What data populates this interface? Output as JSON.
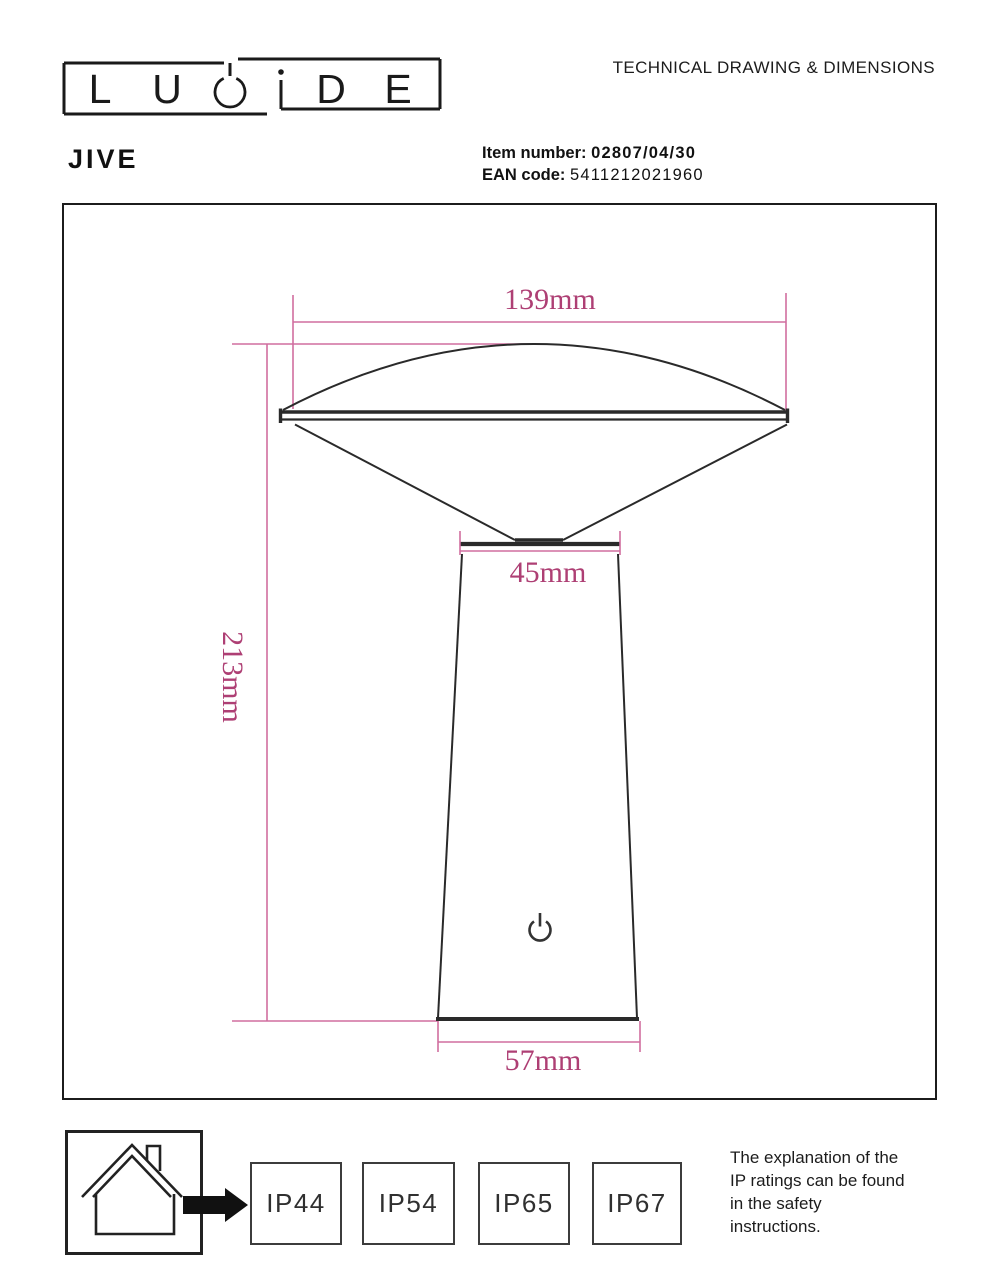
{
  "header": {
    "title": "TECHNICAL DRAWING & DIMENSIONS",
    "brand": "LUCIDE",
    "brand_letters": [
      "L",
      "U",
      "C",
      "i",
      "D",
      "E"
    ],
    "product_name": "JIVE",
    "item_number_label": "Item number:",
    "item_number_value": "02807/04/30",
    "ean_label": "EAN code:",
    "ean_value": "5411212021960"
  },
  "drawing": {
    "dim_top_width": "139mm",
    "dim_neck_width": "45mm",
    "dim_height": "213mm",
    "dim_base_width": "57mm",
    "power_icon": "power-symbol"
  },
  "footer": {
    "ip_ratings": [
      "IP44",
      "IP54",
      "IP65",
      "IP67"
    ],
    "note_lines": [
      "The explanation of the",
      "IP ratings can be found",
      "in the safety",
      "instructions."
    ]
  },
  "colors": {
    "dimension_text": "#ae3f74",
    "dimension_line": "#d06e9f",
    "drawing_line": "#2a2a2a"
  }
}
